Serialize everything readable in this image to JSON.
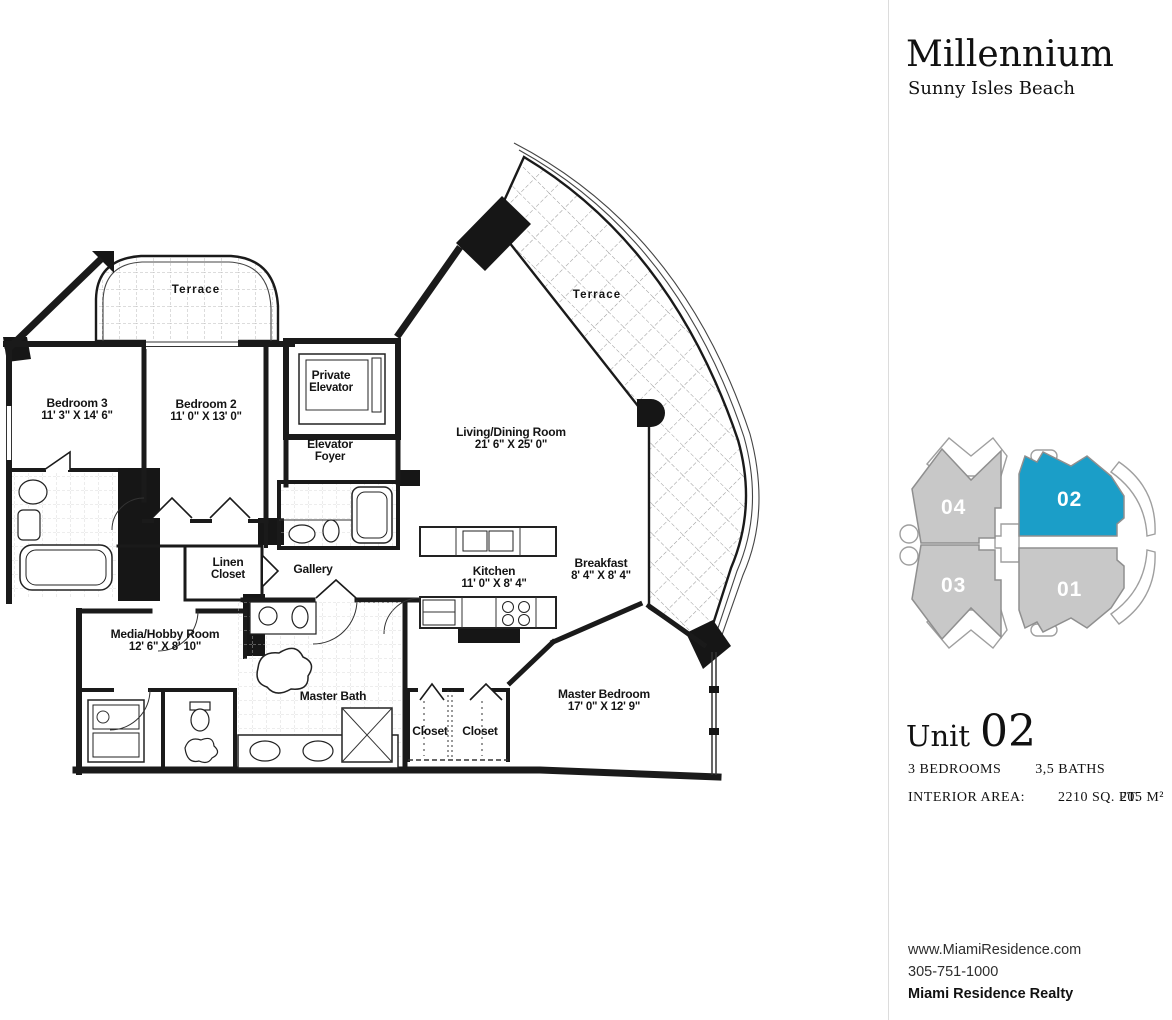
{
  "header": {
    "building": "Millennium",
    "location": "Sunny Isles Beach"
  },
  "keyplan": {
    "highlight_color": "#1b9ec8",
    "default_color": "#c8c8c8",
    "outline_color": "#8f8f8f",
    "units": [
      {
        "label": "04",
        "highlighted": false
      },
      {
        "label": "02",
        "highlighted": true
      },
      {
        "label": "03",
        "highlighted": false
      },
      {
        "label": "01",
        "highlighted": false
      }
    ]
  },
  "unit_info": {
    "label": "Unit",
    "number": "02",
    "bedrooms": "3 BEDROOMS",
    "baths": "3,5 BATHS",
    "area_label": "INTERIOR AREA:",
    "area_sqft": "2210 SQ. FT.",
    "area_m2": "205 M²"
  },
  "contact": {
    "website": "www.MiamiResidence.com",
    "phone": "305-751-1000",
    "company": "Miami Residence Realty"
  },
  "floorplan": {
    "rooms": [
      {
        "id": "terrace-north",
        "line1": "Terrace",
        "line2": "",
        "x": 196,
        "y": 291,
        "spaced": true
      },
      {
        "id": "terrace-east",
        "line1": "Terrace",
        "line2": "",
        "x": 597,
        "y": 296,
        "spaced": true
      },
      {
        "id": "bedroom-3",
        "line1": "Bedroom 3",
        "line2": "11' 3\" X 14' 6\"",
        "x": 77,
        "y": 410
      },
      {
        "id": "bedroom-2",
        "line1": "Bedroom 2",
        "line2": "11' 0\" X 13' 0\"",
        "x": 206,
        "y": 411
      },
      {
        "id": "private-elevator",
        "line1": "Private",
        "line2": "Elevator",
        "x": 331,
        "y": 382
      },
      {
        "id": "elevator-foyer",
        "line1": "Elevator",
        "line2": "Foyer",
        "x": 330,
        "y": 451
      },
      {
        "id": "living-dining",
        "line1": "Living/Dining Room",
        "line2": "21' 6\" X 25' 0\"",
        "x": 511,
        "y": 439
      },
      {
        "id": "linen-closet",
        "line1": "Linen",
        "line2": "Closet",
        "x": 228,
        "y": 569
      },
      {
        "id": "gallery",
        "line1": "Gallery",
        "line2": "",
        "x": 313,
        "y": 569
      },
      {
        "id": "kitchen",
        "line1": "Kitchen",
        "line2": "11' 0\" X 8' 4\"",
        "x": 494,
        "y": 578
      },
      {
        "id": "breakfast",
        "line1": "Breakfast",
        "line2": "8' 4\" X 8' 4\"",
        "x": 601,
        "y": 570
      },
      {
        "id": "media-hobby",
        "line1": "Media/Hobby Room",
        "line2": "12' 6\" X 8' 10\"",
        "x": 165,
        "y": 641
      },
      {
        "id": "master-bath",
        "line1": "Master Bath",
        "line2": "",
        "x": 333,
        "y": 696
      },
      {
        "id": "closet-left",
        "line1": "Closet",
        "line2": "",
        "x": 430,
        "y": 731
      },
      {
        "id": "closet-right",
        "line1": "Closet",
        "line2": "",
        "x": 480,
        "y": 731
      },
      {
        "id": "master-bedroom",
        "line1": "Master Bedroom",
        "line2": "17' 0\" X 12' 9\"",
        "x": 604,
        "y": 701
      }
    ]
  }
}
